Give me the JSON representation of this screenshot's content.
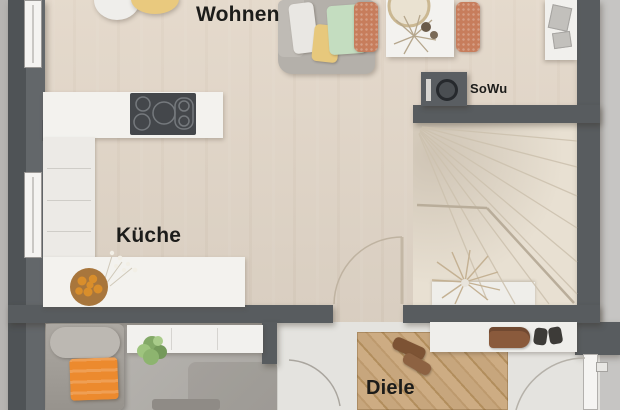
{
  "plan": {
    "type": "apartment-floor-plan",
    "rooms": {
      "wohnen": "Wohnen",
      "kueche": "Küche",
      "diele": "Diele"
    },
    "annotations": {
      "sowu": "SoWu"
    },
    "icons": {
      "sowu_symbol": "water-heater-icon"
    },
    "colors": {
      "wall": "#585c5f",
      "floor_wood": "#dcd2c5",
      "floor_stairs": "#e8e0d2",
      "floor_hall": "#e4e3df",
      "floor_bedroom": "#b3b0ab",
      "wood_mat": "#c09e74",
      "counter_white": "#f3f2ee",
      "cooktop": "#44474b",
      "accent_orange": "#ec8a2e",
      "chair_terracotta": "#c77d5c",
      "plant_green": "#83a967",
      "label_text": "#1c1c1a",
      "background_margin": "#c6c5c3"
    }
  }
}
